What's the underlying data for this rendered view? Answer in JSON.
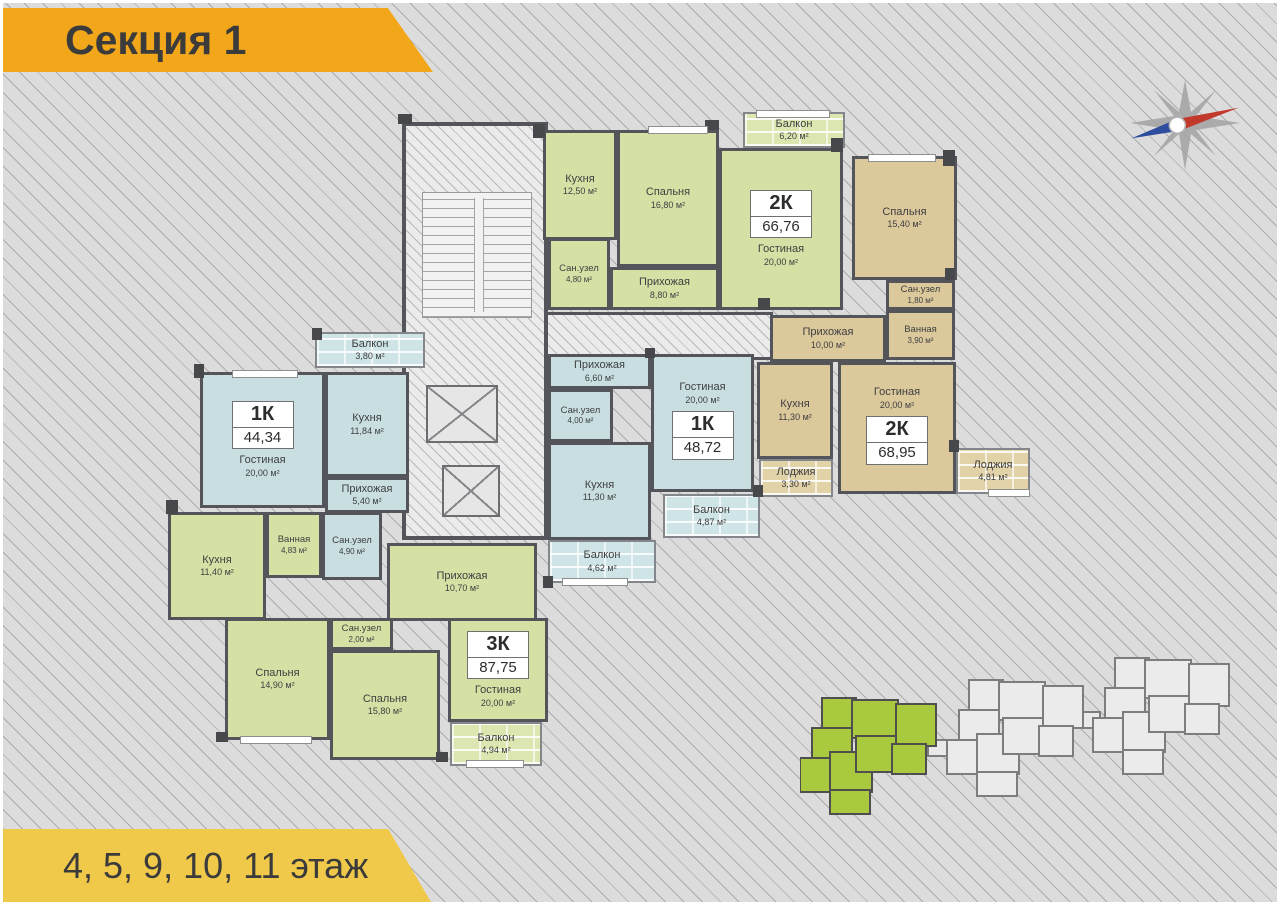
{
  "banners": {
    "section": "Секция 1",
    "floors": "4, 5, 9, 10, 11 этаж"
  },
  "apartments": [
    {
      "type": "2К",
      "total": "66,76",
      "color": "green",
      "rooms": [
        {
          "name": "Кухня",
          "area": "12,50 м²"
        },
        {
          "name": "Спальня",
          "area": "16,80 м²"
        },
        {
          "name": "Балкон",
          "area": "6,20 м²"
        },
        {
          "name": "Сан.узел",
          "area": "4,80 м²"
        },
        {
          "name": "Прихожая",
          "area": "8,80 м²"
        },
        {
          "name": "Гостиная",
          "area": "20,00 м²"
        }
      ]
    },
    {
      "type": "2К",
      "total": "68,95",
      "color": "tan",
      "rooms": [
        {
          "name": "Спальня",
          "area": "15,40 м²"
        },
        {
          "name": "Сан.узел",
          "area": "1,80 м²"
        },
        {
          "name": "Ванная",
          "area": "3,90 м²"
        },
        {
          "name": "Прихожая",
          "area": "10,00 м²"
        },
        {
          "name": "Кухня",
          "area": "11,30 м²"
        },
        {
          "name": "Гостиная",
          "area": "20,00 м²"
        },
        {
          "name": "Лоджия",
          "area": "3,30 м²"
        },
        {
          "name": "Лоджия",
          "area": "4,81 м²"
        }
      ]
    },
    {
      "type": "1К",
      "total": "44,34",
      "color": "blue",
      "rooms": [
        {
          "name": "Балкон",
          "area": "3,80 м²"
        },
        {
          "name": "Гостиная",
          "area": "20,00 м²"
        },
        {
          "name": "Кухня",
          "area": "11,84 м²"
        },
        {
          "name": "Прихожая",
          "area": "5,40 м²"
        },
        {
          "name": "Сан.узел",
          "area": "4,90 м²"
        }
      ]
    },
    {
      "type": "1К",
      "total": "48,72",
      "color": "blue",
      "rooms": [
        {
          "name": "Прихожая",
          "area": "6,60 м²"
        },
        {
          "name": "Сан.узел",
          "area": "4,00 м²"
        },
        {
          "name": "Гостиная",
          "area": "20,00 м²"
        },
        {
          "name": "Кухня",
          "area": "11,30 м²"
        },
        {
          "name": "Балкон",
          "area": "4,87 м²"
        },
        {
          "name": "Балкон",
          "area": "4,62 м²"
        }
      ]
    },
    {
      "type": "3К",
      "total": "87,75",
      "color": "green",
      "rooms": [
        {
          "name": "Кухня",
          "area": "11,40 м²"
        },
        {
          "name": "Ванная",
          "area": "4,83 м²"
        },
        {
          "name": "Прихожая",
          "area": "10,70 м²"
        },
        {
          "name": "Спальня",
          "area": "14,90 м²"
        },
        {
          "name": "Сан.узел",
          "area": "2,00 м²"
        },
        {
          "name": "Спальня",
          "area": "15,80 м²"
        },
        {
          "name": "Гостиная",
          "area": "20,00 м²"
        },
        {
          "name": "Балкон",
          "area": "4,94 м²"
        }
      ]
    }
  ],
  "colors": {
    "banner_orange": "#f2a71b",
    "banner_yellow": "#f1c94a",
    "apartment_green": "#d5e0a4",
    "apartment_blue": "#c8dee0",
    "apartment_tan": "#dbc89b",
    "wall": "#54555a",
    "background": "#dcdcdc",
    "site_plan_highlight": "#a9c93e"
  }
}
